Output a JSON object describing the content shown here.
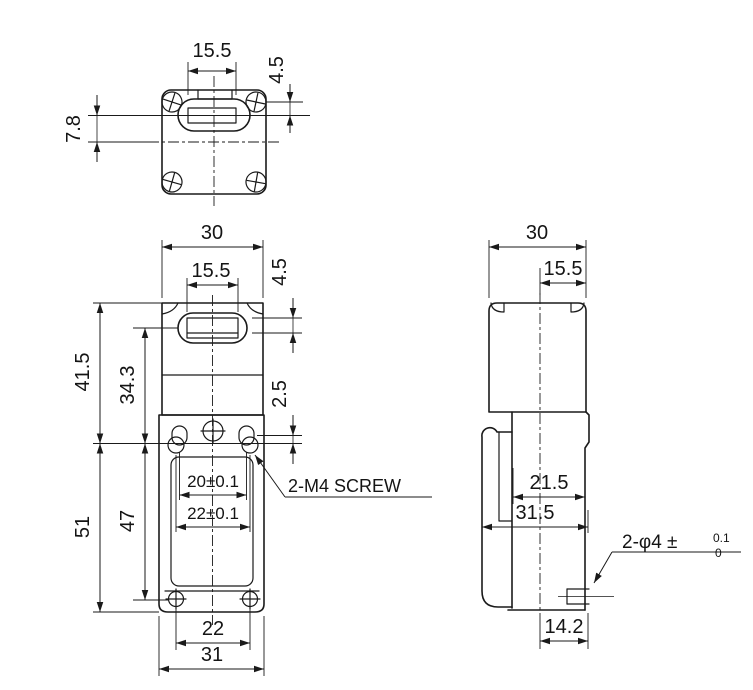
{
  "drawing": {
    "type": "limit-switch dimensional drawing",
    "line_color": "#1a1a1a",
    "background": "#ffffff",
    "dims": {
      "top": {
        "slot_width": "15.5",
        "slot_center_offset": "4.5",
        "depth_offset": "7.8"
      },
      "front": {
        "width": "30",
        "slot_width": "15.5",
        "slot_offset": "4.5",
        "upper_height": "41.5",
        "slot_to_mount": "34.3",
        "mount_hole_offset": "2.5",
        "lower_height": "51",
        "mount_to_screw": "47",
        "hole_pitch_upper": "20±0.1",
        "hole_pitch_lower": "22±0.1",
        "mount_screw_note": "2-M4 SCREW",
        "bottom_screw_pitch": "22",
        "base_width": "31"
      },
      "side": {
        "width": "30",
        "center_to_edge": "15.5",
        "upper_depth": "21.5",
        "full_depth": "31.5",
        "hole_note": "2-φ4 ±",
        "hole_tol_upper": "0.1",
        "hole_tol_lower": "0",
        "hole_offset": "14.2"
      }
    }
  }
}
